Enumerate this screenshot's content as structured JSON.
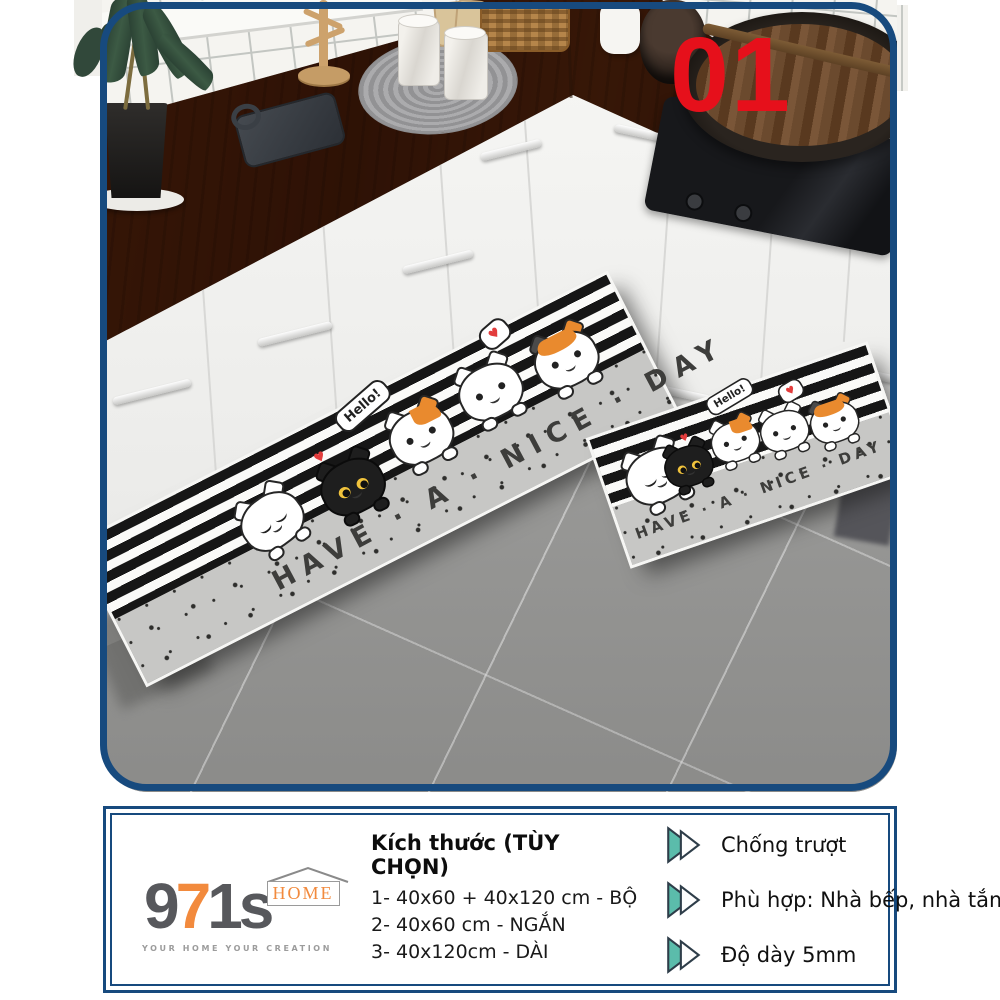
{
  "badge": {
    "number": "01"
  },
  "photo": {
    "mat_text": "HAVE · A · NICE · DAY",
    "hello": "Hello!",
    "heart": "♥"
  },
  "panel": {
    "logo": {
      "part1": "9",
      "part2": "7",
      "part3": "1s",
      "home": "HOME",
      "tagline": "YOUR HOME YOUR CREATION"
    },
    "sizes": {
      "title": "Kích thước (TÙY CHỌN)",
      "options": [
        "1- 40x60 + 40x120 cm - BỘ",
        "2- 40x60 cm - NGẮN",
        "3- 40x120cm - DÀI"
      ]
    },
    "features": [
      "Chống trượt",
      "Phù hợp: Nhà bếp, nhà tắm",
      "Độ dày 5mm"
    ]
  },
  "colors": {
    "frame_navy": "#174a7e",
    "badge_red": "#e6101b",
    "arrow_teal": "#5bbcab",
    "logo_orange": "#f28a3d",
    "logo_gray": "#57585c"
  }
}
